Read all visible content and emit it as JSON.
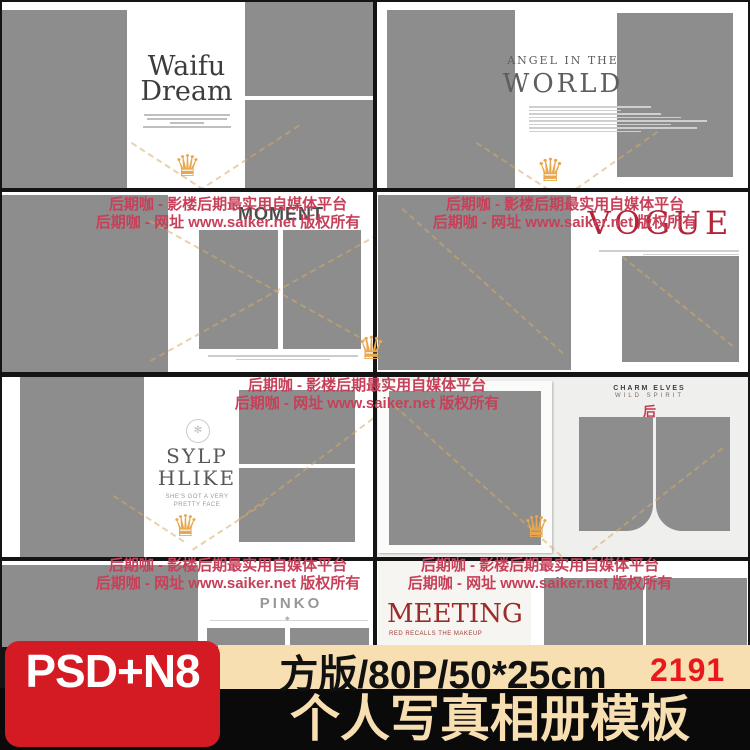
{
  "watermark": {
    "line1": "后期咖 - 影楼后期最实用自媒体平台",
    "line2": "后期咖 - 网址 www.saiker.net 版权所有"
  },
  "templates": {
    "waifu": {
      "title1": "Waifu",
      "title2": "Dream"
    },
    "angel": {
      "title1": "ANGEL IN THE",
      "title2": "WORLD"
    },
    "moment": {
      "title": "MOMENT"
    },
    "vogue": {
      "title": "VOGUE"
    },
    "sylphlike": {
      "title1": "SYLP",
      "title2": "HLIKE",
      "sub1": "SHE'S GOT A VERY",
      "sub2": "PRETTY FACE"
    },
    "charm": {
      "header1": "CHARM ELVES",
      "header2": "WILD SPIRIT",
      "mark": "后"
    },
    "pinko": {
      "title": "PINKO"
    },
    "meeting": {
      "title": "MEETING",
      "subtitle": "RED RECALLS THE MAKEUP"
    }
  },
  "banner": {
    "badge": "PSD+N8",
    "spec": "方版/80P/50*25cm",
    "number": "2191",
    "title": "个人写真相册模板"
  },
  "decor": {
    "crown_glyph": "♛",
    "ornament_glyph": "✻",
    "diamond_glyph": "◆"
  },
  "colors": {
    "photo_placeholder": "#8d8d8d",
    "watermark_red": "#c74059",
    "crown_gold": "#e9a84f",
    "badge_bg": "#d41b24",
    "banner_cream": "#f7dfb2",
    "number_red": "#e8191c",
    "vogue_red": "#b32438",
    "meeting_red": "#9c2b28"
  }
}
